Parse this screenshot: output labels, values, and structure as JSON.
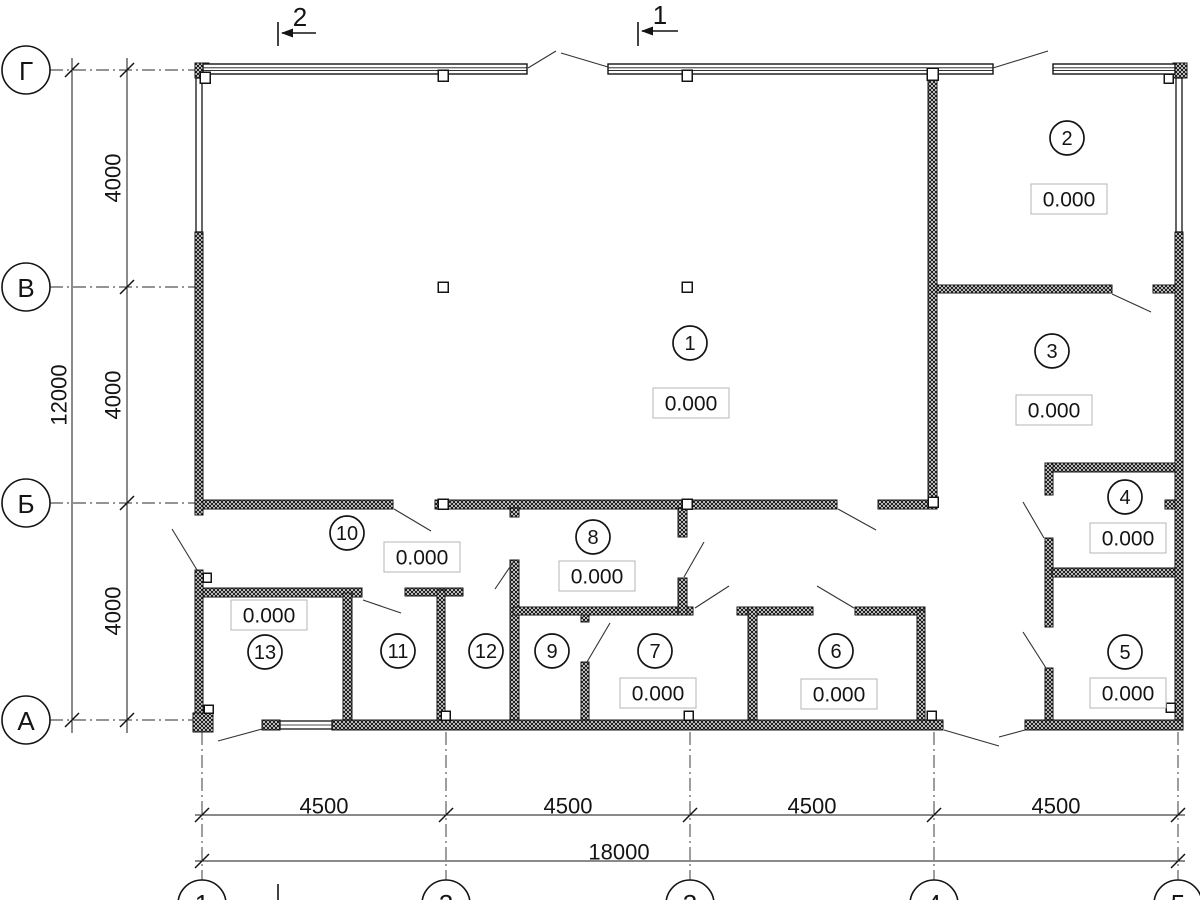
{
  "plan": {
    "canvas": {
      "w": 1200,
      "h": 900,
      "bg": "#ffffff",
      "ink": "#141414",
      "box_border": "#b4b4b4"
    },
    "axes": {
      "rows": [
        {
          "label": "Г",
          "y": 70
        },
        {
          "label": "В",
          "y": 287
        },
        {
          "label": "Б",
          "y": 503
        },
        {
          "label": "А",
          "y": 720
        }
      ],
      "cols": [
        {
          "label": "1",
          "x": 202
        },
        {
          "label": "2",
          "x": 446
        },
        {
          "label": "3",
          "x": 690
        },
        {
          "label": "4",
          "x": 934
        },
        {
          "label": "5",
          "x": 1178
        }
      ],
      "row_bubble": {
        "cx": 26,
        "r": 24
      },
      "col_bubble": {
        "cy": 904,
        "r": 24
      }
    },
    "dimensions": {
      "left_outer": {
        "x": 72,
        "y1": 58,
        "y2": 733,
        "ticks": [
          70,
          720
        ],
        "labels": [
          {
            "text": "12000",
            "x": 59,
            "y": 395
          }
        ]
      },
      "left_inner": {
        "x": 127,
        "y1": 58,
        "y2": 733,
        "ticks": [
          70,
          287,
          503,
          720
        ],
        "labels": [
          {
            "text": "4000",
            "x": 113,
            "y": 178
          },
          {
            "text": "4000",
            "x": 113,
            "y": 395
          },
          {
            "text": "4000",
            "x": 113,
            "y": 611
          }
        ]
      },
      "bottom_inner": {
        "y": 815,
        "x1": 195,
        "x2": 1185,
        "ticks": [
          202,
          446,
          690,
          934,
          1178
        ],
        "labels": [
          {
            "text": "4500",
            "x": 324,
            "y": 806
          },
          {
            "text": "4500",
            "x": 568,
            "y": 806
          },
          {
            "text": "4500",
            "x": 812,
            "y": 806
          },
          {
            "text": "4500",
            "x": 1056,
            "y": 806
          }
        ]
      },
      "bottom_outer": {
        "y": 861,
        "x1": 195,
        "x2": 1185,
        "ticks": [
          202,
          1178
        ],
        "labels": [
          {
            "text": "18000",
            "x": 619,
            "y": 852
          }
        ]
      }
    },
    "sections": [
      {
        "label": "2",
        "lx": 300,
        "ly": 17,
        "tick": [
          278,
          22,
          278,
          46
        ],
        "shaft": [
          316,
          33,
          282,
          33
        ],
        "head": [
          281,
          33
        ]
      },
      {
        "label": "1",
        "lx": 660,
        "ly": 15,
        "tick": [
          638,
          22,
          638,
          46
        ],
        "shaft": [
          678,
          31,
          642,
          31
        ],
        "head": [
          641,
          31
        ]
      }
    ],
    "section_stubs": [
      [
        278,
        884,
        278,
        900
      ]
    ],
    "rooms": [
      {
        "number": "1",
        "cx": 690,
        "cy": 343,
        "elevation": "0.000",
        "ex": 691,
        "ey": 403
      },
      {
        "number": "2",
        "cx": 1067,
        "cy": 138,
        "elevation": "0.000",
        "ex": 1069,
        "ey": 199
      },
      {
        "number": "3",
        "cx": 1052,
        "cy": 351,
        "elevation": "0.000",
        "ex": 1054,
        "ey": 410
      },
      {
        "number": "4",
        "cx": 1125,
        "cy": 497,
        "elevation": "0.000",
        "ex": 1128,
        "ey": 538
      },
      {
        "number": "5",
        "cx": 1125,
        "cy": 652,
        "elevation": "0.000",
        "ex": 1128,
        "ey": 693
      },
      {
        "number": "6",
        "cx": 836,
        "cy": 651,
        "elevation": "0.000",
        "ex": 839,
        "ey": 694
      },
      {
        "number": "7",
        "cx": 655,
        "cy": 651,
        "elevation": "0.000",
        "ex": 658,
        "ey": 693
      },
      {
        "number": "8",
        "cx": 593,
        "cy": 537,
        "elevation": "0.000",
        "ex": 597,
        "ey": 576
      },
      {
        "number": "9",
        "cx": 552,
        "cy": 651
      },
      {
        "number": "10",
        "cx": 347,
        "cy": 533,
        "elevation": "0.000",
        "ex": 422,
        "ey": 557
      },
      {
        "number": "11",
        "cx": 398,
        "cy": 651
      },
      {
        "number": "12",
        "cx": 486,
        "cy": 651
      },
      {
        "number": "13",
        "cx": 265,
        "cy": 652,
        "elevation": "0.000",
        "ex": 269,
        "ey": 615
      }
    ],
    "geometry": {
      "walls": [
        [
          195,
          63,
          14,
          15
        ],
        [
          195,
          232,
          8,
          283
        ],
        [
          195,
          570,
          8,
          157
        ],
        [
          928,
          72,
          9,
          436
        ],
        [
          937,
          285,
          175,
          8
        ],
        [
          1153,
          285,
          22,
          8
        ],
        [
          1173,
          63,
          14,
          15
        ],
        [
          1175,
          232,
          8,
          496
        ],
        [
          203,
          500,
          190,
          9
        ],
        [
          435,
          500,
          402,
          9
        ],
        [
          878,
          500,
          59,
          9
        ],
        [
          1165,
          500,
          10,
          9
        ],
        [
          203,
          588,
          159,
          9
        ],
        [
          343,
          593,
          9,
          127
        ],
        [
          405,
          588,
          58,
          8
        ],
        [
          437,
          590,
          8,
          130
        ],
        [
          510,
          508,
          9,
          9
        ],
        [
          510,
          560,
          9,
          160
        ],
        [
          513,
          607,
          180,
          8
        ],
        [
          581,
          615,
          8,
          7
        ],
        [
          581,
          662,
          8,
          58
        ],
        [
          678,
          508,
          9,
          29
        ],
        [
          678,
          578,
          9,
          37
        ],
        [
          737,
          607,
          76,
          8
        ],
        [
          855,
          607,
          70,
          8
        ],
        [
          748,
          607,
          9,
          113
        ],
        [
          917,
          610,
          8,
          110
        ],
        [
          1045,
          463,
          130,
          9
        ],
        [
          1045,
          463,
          8,
          32
        ],
        [
          1045,
          538,
          8,
          89
        ],
        [
          1045,
          668,
          8,
          52
        ],
        [
          1052,
          568,
          123,
          9
        ],
        [
          193,
          713,
          20,
          19
        ],
        [
          262,
          720,
          18,
          10
        ],
        [
          332,
          720,
          611,
          10
        ],
        [
          1025,
          720,
          158,
          10
        ]
      ],
      "windows_top": [
        [
          203,
          64,
          324,
          10
        ],
        [
          608,
          64,
          385,
          10
        ],
        [
          1053,
          64,
          122,
          10
        ]
      ],
      "windows_side": [
        [
          196,
          78,
          6,
          154
        ],
        [
          1176,
          78,
          6,
          154
        ]
      ],
      "window_bottom": [
        [
          280,
          721,
          52,
          8
        ]
      ],
      "columns": [
        [
          200,
          72,
          10,
          11
        ],
        [
          438,
          70,
          10,
          11
        ],
        [
          682,
          70,
          10,
          11
        ],
        [
          927,
          68,
          11,
          12
        ],
        [
          1164,
          74,
          9,
          9
        ],
        [
          438,
          282,
          10,
          10
        ],
        [
          682,
          282,
          10,
          10
        ],
        [
          438,
          499,
          10,
          10
        ],
        [
          682,
          499,
          10,
          10
        ],
        [
          928,
          497,
          10,
          10
        ],
        [
          441,
          711,
          9,
          9
        ],
        [
          684,
          711,
          9,
          9
        ],
        [
          927,
          711,
          9,
          9
        ],
        [
          204,
          705,
          9,
          8
        ],
        [
          203,
          573,
          8,
          9
        ],
        [
          1166,
          703,
          9,
          9
        ]
      ],
      "door_lines": [
        [
          528,
          68,
          556,
          51
        ],
        [
          561,
          53,
          608,
          67
        ],
        [
          993,
          68,
          1048,
          51
        ],
        [
          1112,
          294,
          1151,
          312
        ],
        [
          172,
          529,
          197,
          570
        ],
        [
          394,
          509,
          431,
          531
        ],
        [
          838,
          509,
          876,
          530
        ],
        [
          363,
          600,
          401,
          613
        ],
        [
          495,
          589,
          514,
          561
        ],
        [
          587,
          662,
          610,
          623
        ],
        [
          684,
          577,
          704,
          542
        ],
        [
          695,
          608,
          729,
          586
        ],
        [
          817,
          586,
          854,
          608
        ],
        [
          1023,
          502,
          1044,
          538
        ],
        [
          1023,
          632,
          1046,
          668
        ],
        [
          944,
          730,
          999,
          746
        ],
        [
          999,
          737,
          1025,
          730
        ],
        [
          218,
          741,
          262,
          729
        ]
      ]
    }
  }
}
